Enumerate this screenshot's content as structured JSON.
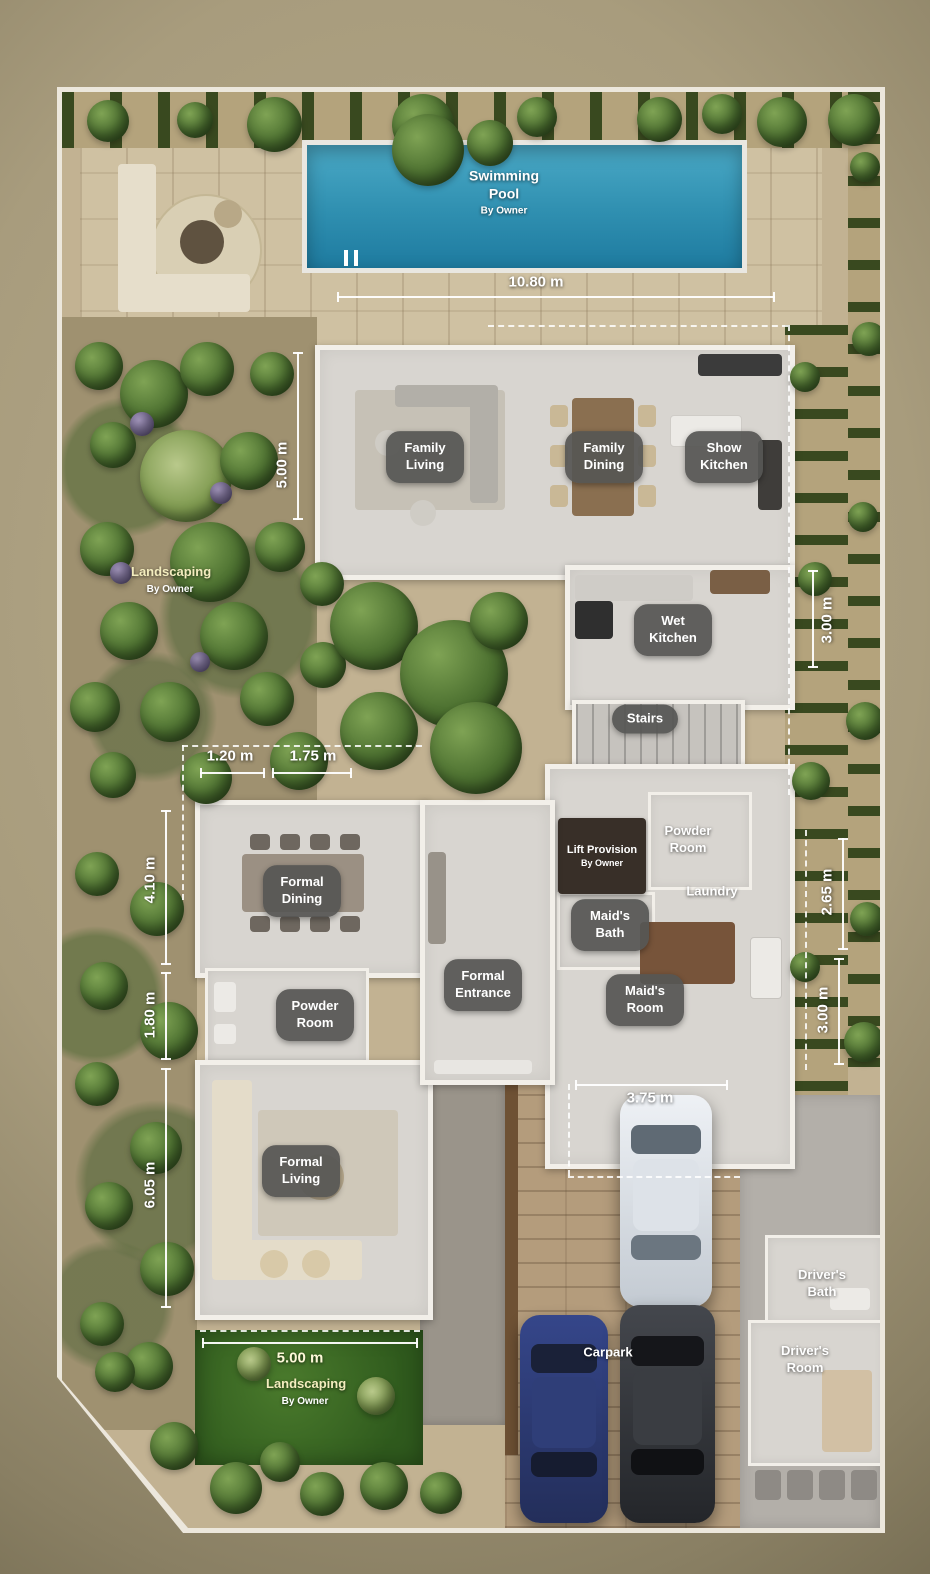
{
  "plan_type": "ground-floor-plan",
  "rooms": {
    "family_living": "Family Living",
    "family_dining": "Family Dining",
    "show_kitchen": "Show Kitchen",
    "wet_kitchen": "Wet Kitchen",
    "stairs": "Stairs",
    "formal_dining": "Formal Dining",
    "formal_entrance": "Formal Entrance",
    "formal_living": "Formal Living",
    "powder_room_left": "Powder Room",
    "powder_room_right": "Powder Room",
    "laundry": "Laundry",
    "maids_bath": "Maid's Bath",
    "maids_room": "Maid's Room",
    "carpark": "Carpark",
    "drivers_bath": "Driver's Bath",
    "drivers_room": "Driver's Room"
  },
  "lift": {
    "label": "Lift Provision",
    "sub": "By Owner"
  },
  "pool": {
    "label": "Swimming Pool",
    "sub": "By Owner"
  },
  "landscaping": {
    "left": "Landscaping",
    "left_sub": "By Owner",
    "bottom": "Landscaping",
    "bottom_sub": "By Owner"
  },
  "dimensions": {
    "top_width": "10.80 m",
    "family_living_depth": "5.00 m",
    "wet_kitchen_depth": "3.00 m",
    "court_a": "1.20 m",
    "court_b": "1.75 m",
    "formal_dining_depth": "4.10 m",
    "powder_depth": "1.80 m",
    "formal_living_depth": "6.05 m",
    "right_a": "2.65 m",
    "right_b": "3.00 m",
    "carpark_width": "3.75 m",
    "landscape_width": "5.00 m"
  },
  "colors": {
    "pool_water": "#2f8fb0",
    "badge": "#565654",
    "deck": "#cfc1a2",
    "grass": "#36631f",
    "floor": "#d8d5d0",
    "car_blue": "#2f3e78",
    "car_black": "#3a3d42",
    "car_white": "#e8ecf0"
  }
}
